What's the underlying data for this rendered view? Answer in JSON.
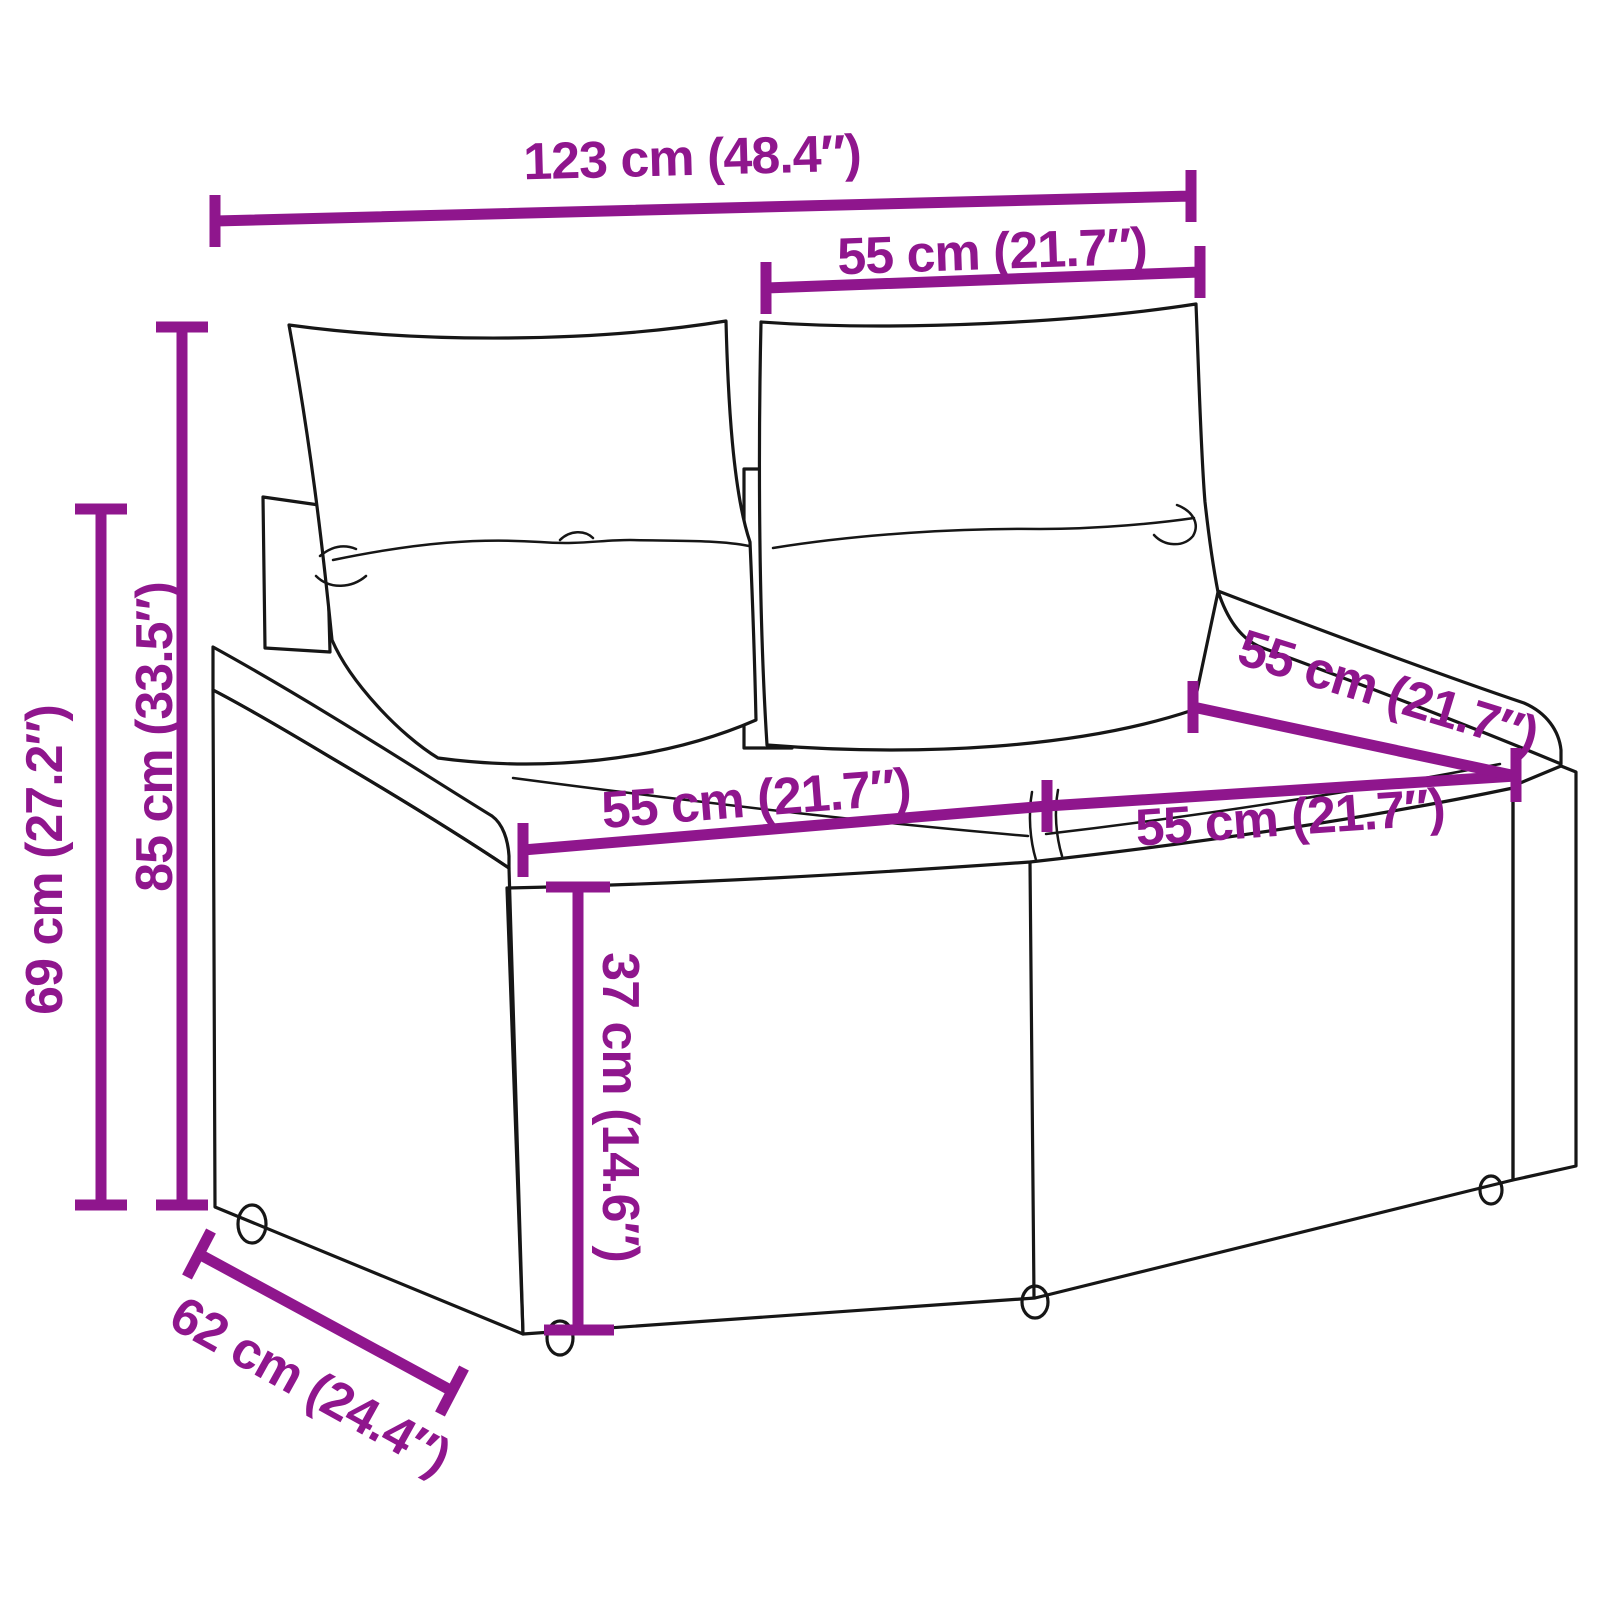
{
  "meta": {
    "description": "Line-art product dimension diagram of a two-seater poly-rattan garden sofa with back cushions and seat cushions"
  },
  "style": {
    "dimension_color": "#8F168D",
    "line_art_color": "#161616",
    "background": "#FFFFFF"
  },
  "dimensions": {
    "overall_width": {
      "label": "123 cm (48.4″)"
    },
    "back_cushion_width": {
      "label": "55 cm (21.7″)"
    },
    "seat_depth": {
      "label": "55 cm (21.7″)"
    },
    "seat_left_width": {
      "label": "55 cm (21.7″)"
    },
    "seat_right_width": {
      "label": "55 cm (21.7″)"
    },
    "overall_height": {
      "label": "85 cm (33.5″)"
    },
    "armrest_height": {
      "label": "69 cm (27.2″)"
    },
    "seat_height": {
      "label": "37 cm (14.6″)"
    },
    "overall_depth": {
      "label": "62 cm (24.4″)"
    }
  }
}
